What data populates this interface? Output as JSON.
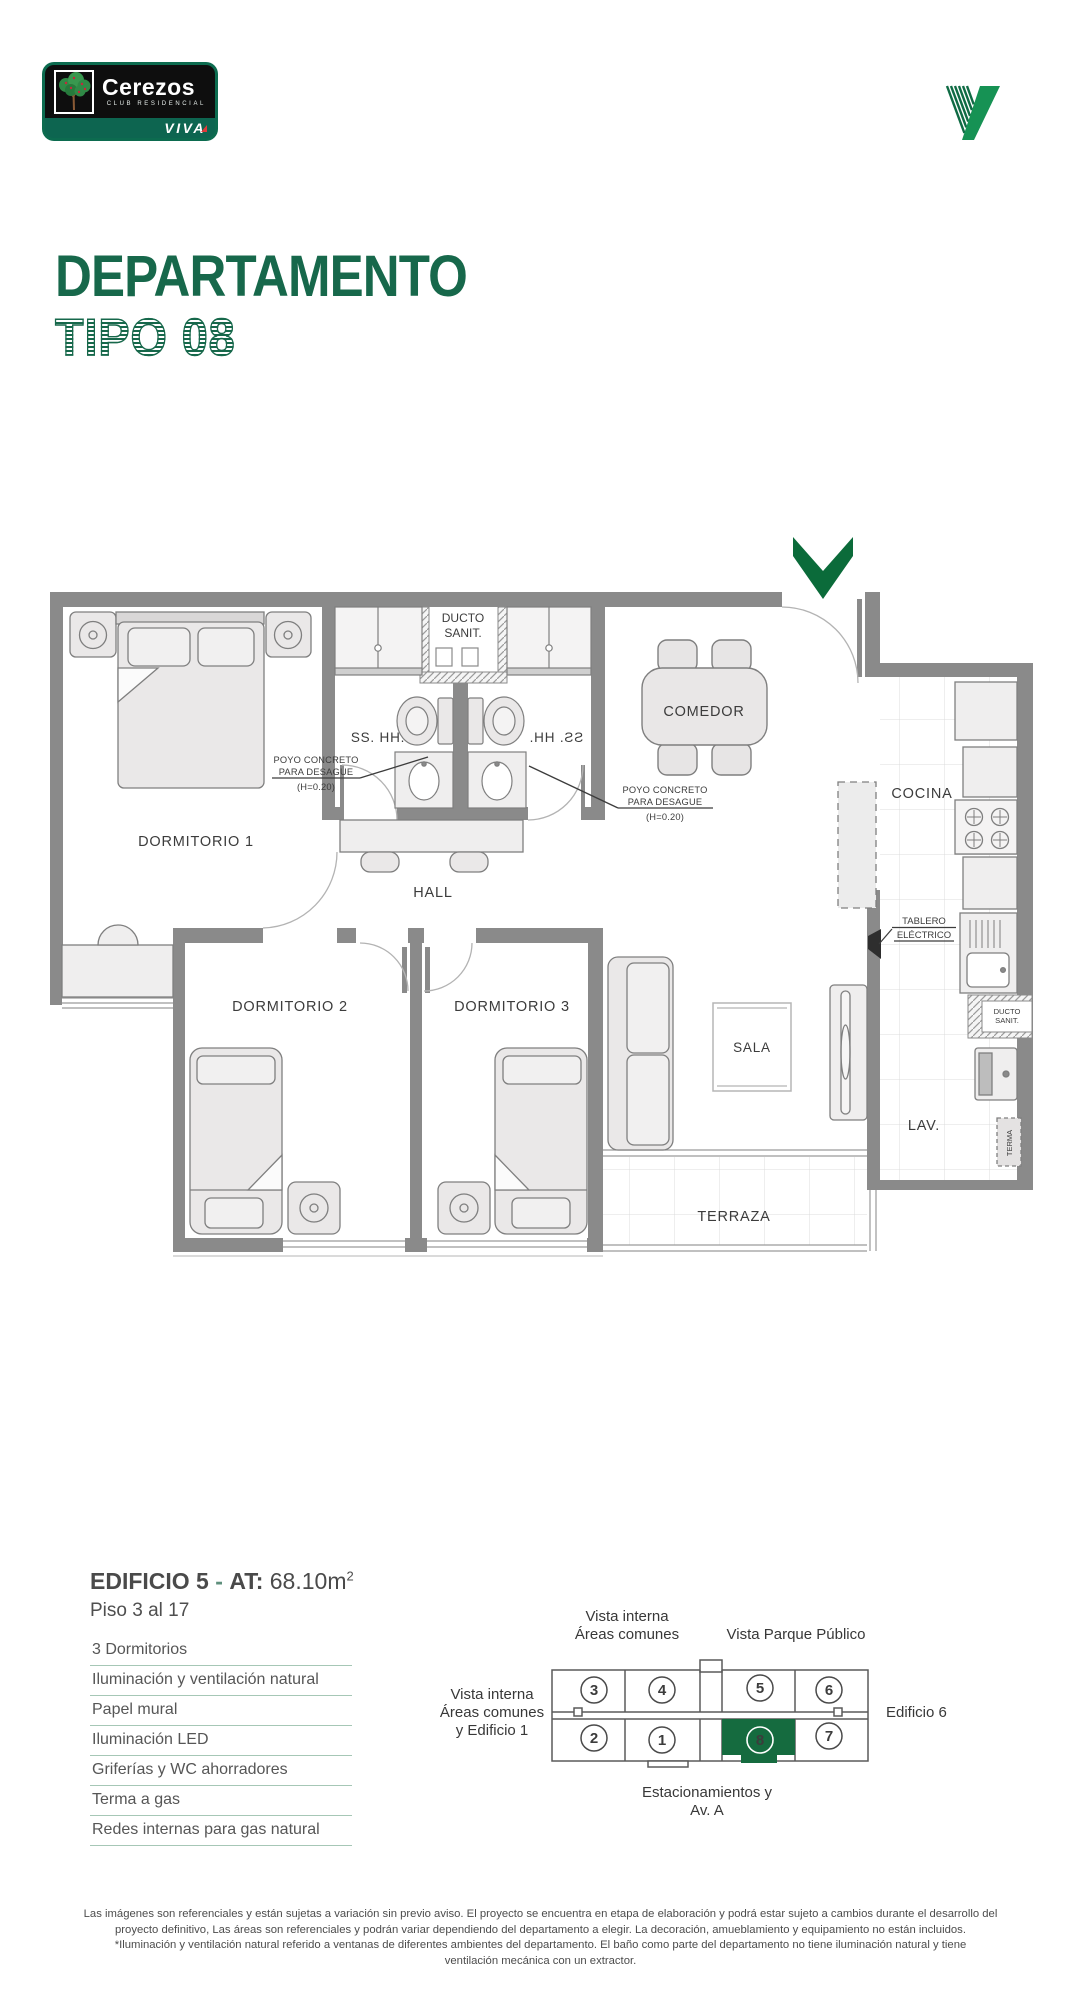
{
  "logo": {
    "name": "Cerezos",
    "tagline": "CLUB RESIDENCIAL",
    "brand": "VIVA"
  },
  "header": {
    "title": "DEPARTAMENTO",
    "subtitle": "TIPO 08"
  },
  "plan": {
    "dormitorio1": "DORMITORIO 1",
    "dormitorio2": "DORMITORIO 2",
    "dormitorio3": "DORMITORIO 3",
    "hall": "HALL",
    "comedor": "COMEDOR",
    "cocina": "COCINA",
    "sala": "SALA",
    "terraza": "TERRAZA",
    "lav": "LAV.",
    "sshh": "SS. HH.",
    "ducto_line1": "DUCTO",
    "ducto_line2": "SANIT.",
    "poyo_line1": "POYO CONCRETO",
    "poyo_line2": "PARA DESAGUE",
    "poyo_line3": "(H=0.20)",
    "tablero_line1": "TABLERO",
    "tablero_line2": "ELÉCTRICO",
    "terma": "TERMA"
  },
  "details": {
    "building": "EDIFICIO 5",
    "dash": "-",
    "at_label": "AT:",
    "area": "68.10m",
    "area_exp": "2",
    "floors": "Piso 3 al 17",
    "features": [
      "3 Dormitorios",
      "Iluminación y ventilación natural",
      "Papel mural",
      "Iluminación LED",
      "Griferías y WC ahorradores",
      "Terma a gas",
      "Redes internas para gas natural"
    ]
  },
  "keyplan": {
    "top_left_1": "Vista interna",
    "top_left_2": "Áreas comunes",
    "top_right": "Vista Parque Público",
    "left_1": "Vista interna",
    "left_2": "Áreas comunes",
    "left_3": "y Edificio 1",
    "right": "Edificio 6",
    "bottom_1": "Estacionamientos y",
    "bottom_2": "Av. A",
    "units": [
      "3",
      "4",
      "5",
      "6",
      "2",
      "1",
      "8",
      "7"
    ],
    "highlighted_unit": "8"
  },
  "colors": {
    "brand_green": "#17684B",
    "arrow_green": "#0B6B3A",
    "unit_green": "#156B3F",
    "separator_green": "#a6c7b6"
  },
  "disclaimer": [
    "Las imágenes son referenciales y están sujetas a variación sin previo aviso. El proyecto se encuentra en etapa de elaboración y podrá estar sujeto a cambios durante el desarrollo del",
    "proyecto definitivo, Las áreas son referenciales y podrán variar dependiendo del departamento a elegir. La decoración, amueblamiento y equipamiento no están incluidos.",
    "*Iluminación y ventilación natural referido a ventanas de diferentes ambientes del departamento. El baño como parte del departamento no tiene iluminación natural y tiene",
    "ventilación mecánica con un extractor."
  ]
}
